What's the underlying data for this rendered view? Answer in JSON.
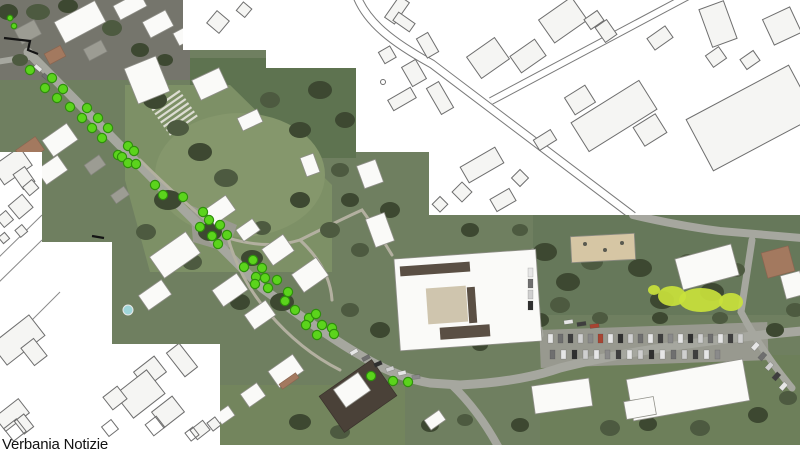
{
  "caption": "Verbania Notizie",
  "map": {
    "description_labels": [],
    "marker_legend": "street-tree-marker"
  },
  "colors": {
    "marker": "#5bd41c",
    "marker_edge": "#2f8f0c",
    "caption_color": "#111111",
    "cad_fill": "#f5f5f3",
    "cad_line": "#6e6e6e",
    "road": "#a6a79f",
    "roof": "#fafaf8",
    "grass": "#6f7f60",
    "highlight": "#c9e23b",
    "pool": "#9fd6da"
  },
  "markers": [
    {
      "x": 10,
      "y": 18,
      "r": 2.8
    },
    {
      "x": 14,
      "y": 26,
      "r": 2.8
    },
    {
      "x": 30,
      "y": 70
    },
    {
      "x": 52,
      "y": 78
    },
    {
      "x": 45,
      "y": 88
    },
    {
      "x": 63,
      "y": 89
    },
    {
      "x": 57,
      "y": 98
    },
    {
      "x": 70,
      "y": 107
    },
    {
      "x": 87,
      "y": 108
    },
    {
      "x": 82,
      "y": 118
    },
    {
      "x": 98,
      "y": 118
    },
    {
      "x": 92,
      "y": 128
    },
    {
      "x": 108,
      "y": 128
    },
    {
      "x": 102,
      "y": 138
    },
    {
      "x": 118,
      "y": 155
    },
    {
      "x": 128,
      "y": 146
    },
    {
      "x": 134,
      "y": 151
    },
    {
      "x": 122,
      "y": 157
    },
    {
      "x": 128,
      "y": 163
    },
    {
      "x": 136,
      "y": 164
    },
    {
      "x": 155,
      "y": 185
    },
    {
      "x": 163,
      "y": 195
    },
    {
      "x": 183,
      "y": 197
    },
    {
      "x": 203,
      "y": 212
    },
    {
      "x": 209,
      "y": 220
    },
    {
      "x": 200,
      "y": 227
    },
    {
      "x": 220,
      "y": 225
    },
    {
      "x": 227,
      "y": 235
    },
    {
      "x": 212,
      "y": 236
    },
    {
      "x": 218,
      "y": 244
    },
    {
      "x": 253,
      "y": 260
    },
    {
      "x": 244,
      "y": 267
    },
    {
      "x": 262,
      "y": 268
    },
    {
      "x": 256,
      "y": 277
    },
    {
      "x": 265,
      "y": 278
    },
    {
      "x": 255,
      "y": 284
    },
    {
      "x": 277,
      "y": 280
    },
    {
      "x": 268,
      "y": 288
    },
    {
      "x": 288,
      "y": 292
    },
    {
      "x": 285,
      "y": 301
    },
    {
      "x": 295,
      "y": 310
    },
    {
      "x": 309,
      "y": 318
    },
    {
      "x": 316,
      "y": 314
    },
    {
      "x": 306,
      "y": 325
    },
    {
      "x": 322,
      "y": 325
    },
    {
      "x": 332,
      "y": 328
    },
    {
      "x": 317,
      "y": 335
    },
    {
      "x": 334,
      "y": 334
    },
    {
      "x": 371,
      "y": 376
    },
    {
      "x": 393,
      "y": 381
    },
    {
      "x": 408,
      "y": 382
    }
  ]
}
